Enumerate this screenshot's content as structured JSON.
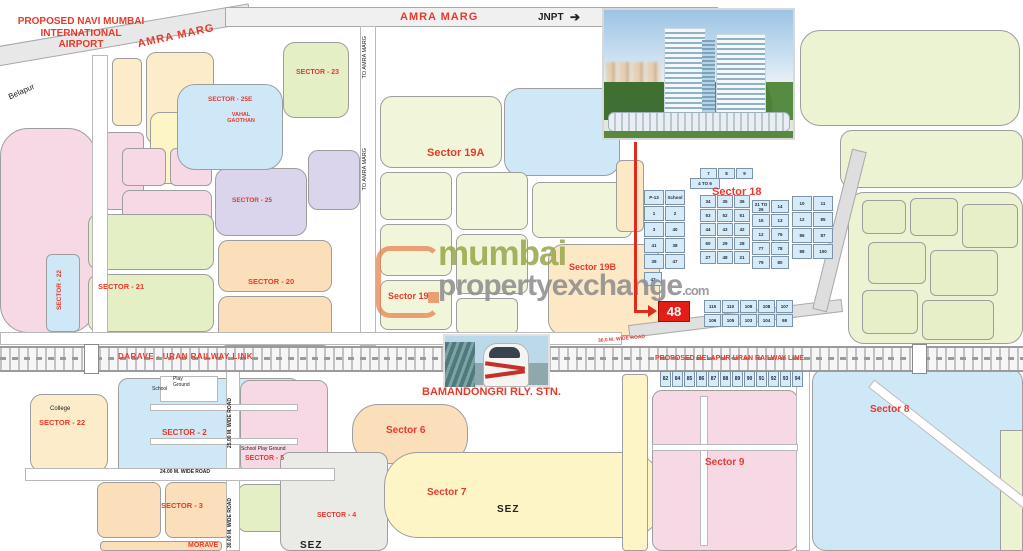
{
  "airport": {
    "label": "PROPOSED  NAVI MUMBAI\nINTERNATIONAL\nAIRPORT"
  },
  "roads": {
    "amra_marg_diagonal": "AMRA MARG",
    "amra_marg_top": "AMRA MARG",
    "jnpt": "JNPT",
    "jnpt_arrow": "➔",
    "belapur": "Belapur",
    "to_amra_marg_1": "TO AMRA MARG",
    "to_amra_marg_2": "TO AMRA MARG",
    "wide_24": "24.00 M. WIDE ROAD",
    "wide_25": "25.00 M. WIDE ROAD",
    "wide_30": "30.00 M. WIDE ROAD",
    "wide_36": "36.0 M. WIDE ROAD"
  },
  "railway": {
    "darave": "DARAVE - URAN RAILWAY LINK",
    "proposed": "PROPOSED BELAPUR-URAN RAILWAY LINE",
    "station": "BAMANDONGRI RLY. STN."
  },
  "sectors": {
    "s23": {
      "label": "SECTOR - 23"
    },
    "s25e": {
      "label": "SECTOR - 25E"
    },
    "vahal": {
      "label": "VAHAL\nGAOTHAN"
    },
    "s25": {
      "label": "SECTOR - 25"
    },
    "s19a": {
      "label": "Sector 19A"
    },
    "s22v": {
      "label": "SECTOR - 22"
    },
    "s21": {
      "label": "SECTOR - 21"
    },
    "s20": {
      "label": "SECTOR - 20"
    },
    "s19": {
      "label": "Sector 19"
    },
    "s19b": {
      "label": "Sector 19B"
    },
    "s18": {
      "label": "Sector 18"
    },
    "s22b": {
      "label": "SECTOR - 22"
    },
    "s2": {
      "label": "SECTOR - 2"
    },
    "s5": {
      "label": "SECTOR - 5"
    },
    "s6": {
      "label": "Sector 6"
    },
    "s7": {
      "label": "Sector 7"
    },
    "s3": {
      "label": "SECTOR - 3"
    },
    "s4": {
      "label": "SECTOR - 4"
    },
    "s8": {
      "label": "Sector 8"
    },
    "s9": {
      "label": "Sector 9"
    }
  },
  "places": {
    "college": "College",
    "school_top": "School",
    "playground_top": "Play\nGround",
    "school_playground": "School   Play Ground",
    "sez_1": "SEZ",
    "sez_2": "SEZ",
    "morave": "MORAVE"
  },
  "marker": {
    "label": "48"
  },
  "watermark": {
    "brand1": "mumbai",
    "brand2": "propertyexchange",
    "tld": ".com"
  },
  "plots": {
    "row_top": [
      "7",
      "8",
      "9"
    ],
    "cluster1": [
      "P-13",
      "School",
      "1",
      "2",
      "3",
      "40",
      "41",
      "38",
      "39",
      "47"
    ],
    "cluster2": [
      "4 TO 6"
    ],
    "cluster3": [
      "34",
      "35",
      "36",
      "53",
      "52",
      "51",
      "44",
      "43",
      "42",
      "60",
      "29",
      "28",
      "27",
      "48",
      "21"
    ],
    "cluster4": [
      "21 TO 26",
      "14",
      "15",
      "13",
      "12",
      "76",
      "77",
      "78",
      "79",
      "80"
    ],
    "cluster5": [
      "10",
      "11",
      "12",
      "85",
      "86",
      "87",
      "88",
      "100"
    ],
    "cluster6": [
      "115",
      "110",
      "109",
      "108",
      "107",
      "106",
      "105",
      "103",
      "104",
      "98"
    ],
    "cluster7": [
      "47"
    ],
    "strip": [
      "82",
      "84",
      "85",
      "86",
      "87",
      "88",
      "89",
      "90",
      "91",
      "92",
      "93",
      "94"
    ]
  },
  "colors": {
    "label_red": "#e8392b",
    "marker_red": "#e31e18",
    "watermark_green": "#9aa84f",
    "watermark_gray": "#8f8f8f",
    "logo_orange": "#e8824f",
    "railway_gray": "#9b9b9b"
  }
}
